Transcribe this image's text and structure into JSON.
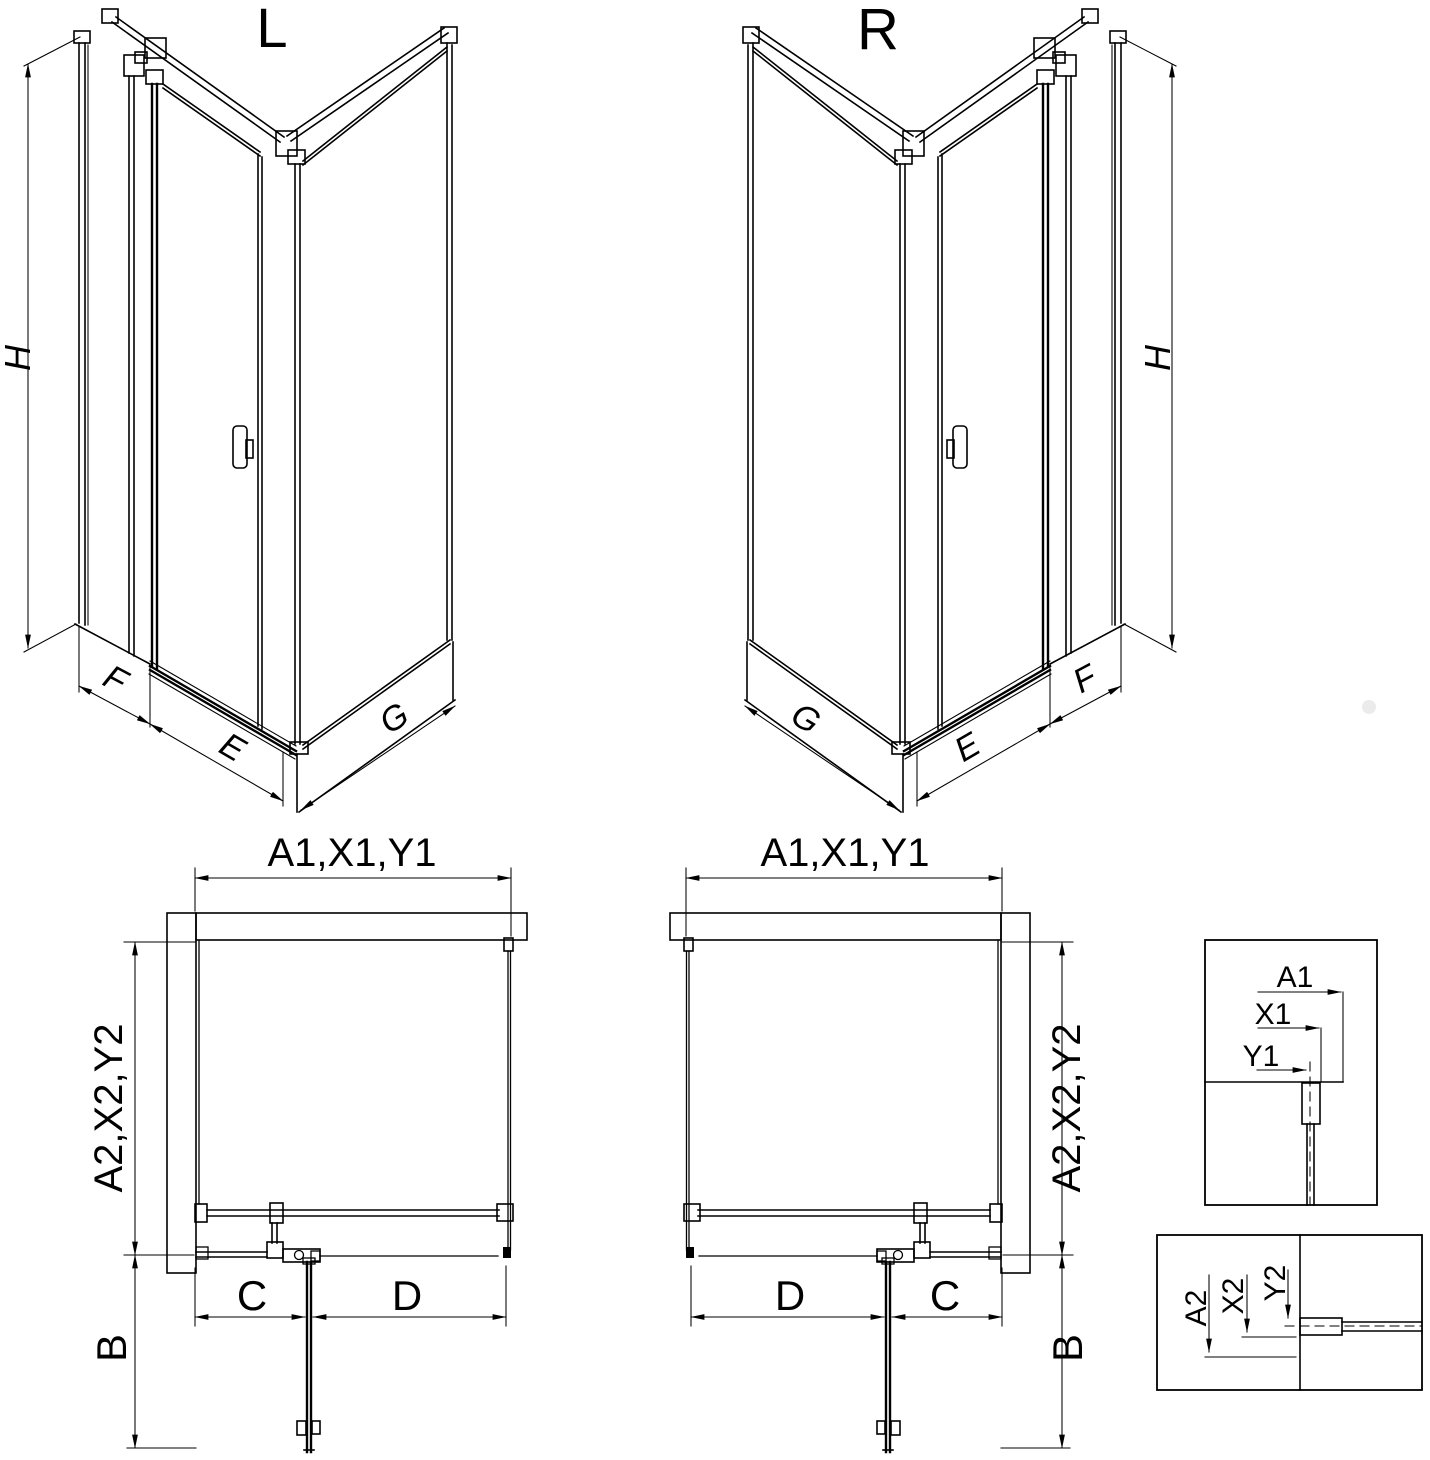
{
  "drawing": {
    "iso_left": {
      "view_label": "L",
      "dim_height": "H",
      "dim_side": "F",
      "dim_door": "E",
      "dim_return": "G"
    },
    "iso_right": {
      "view_label": "R",
      "dim_height": "H",
      "dim_side": "F",
      "dim_door": "E",
      "dim_return": "G"
    },
    "plan_left": {
      "dim_width": "A1,X1,Y1",
      "dim_depth": "A2,X2,Y2",
      "dim_door_open": "B",
      "dim_fixed": "C",
      "dim_door": "D"
    },
    "plan_right": {
      "dim_width": "A1,X1,Y1",
      "dim_depth": "A2,X2,Y2",
      "dim_door_open": "B",
      "dim_fixed": "C",
      "dim_door": "D"
    },
    "detail_top": {
      "dims": [
        "A1",
        "X1",
        "Y1"
      ]
    },
    "detail_bottom": {
      "dims": [
        "A2",
        "X2",
        "Y2"
      ]
    }
  },
  "colors": {
    "line": "#000000",
    "background": "#ffffff",
    "watermark_dot": "#ebebeb"
  }
}
